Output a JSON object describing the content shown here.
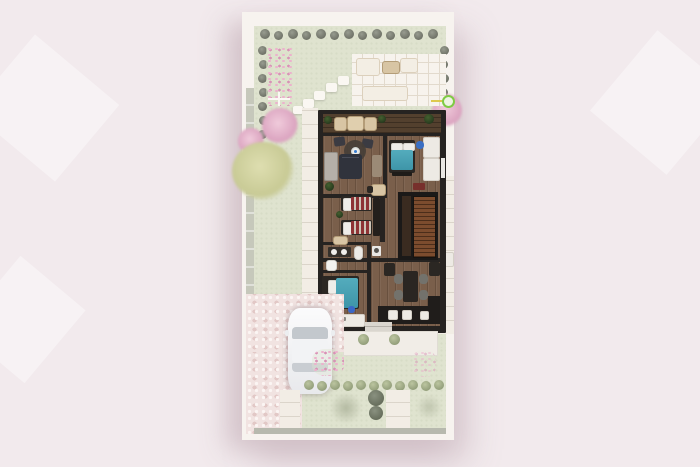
{
  "scene": {
    "kind": "architectural-site-plan-3d-render",
    "description": "Top-down render of a house ground floor with backyard patio, garden, front driveway and parked car",
    "visible_text": "none",
    "palette": {
      "page_background": "#f2eaed",
      "plan_paper": "#f7f3ef",
      "lawn": "#dfe3cf",
      "gray_path": "#c6c8bb",
      "patio_tile": "#f7f3ed",
      "house_wall": "#262321",
      "wood_floor": "#7a5f4b",
      "terrace_deck": "#53402e",
      "stair_wood": "#7c4c2e",
      "bed_blanket_teal": "#47a2b5",
      "kids_blanket_red": "#8e3335",
      "pink_blossom": "#dba4c0",
      "yellow_tree": "#c8ca95",
      "driveway_paver": "#f1e3e1",
      "car_body": "#f5f5f7",
      "hose_marker_green": "#7fcb45"
    }
  },
  "garden": {
    "backyard": [
      "hedge-row-top",
      "hedge-row-left",
      "hedge-row-right",
      "pink-flower-bed",
      "pink-tree",
      "yellow-tree",
      "paved-patio",
      "outdoor-lounge-set",
      "stepping-stones",
      "hose-marker"
    ],
    "frontyard": [
      "driveway",
      "parked-car",
      "front-lawn",
      "pink-flower-patches",
      "bush-row",
      "street-strip",
      "gray-tree"
    ]
  },
  "house": {
    "rooms": [
      {
        "name": "terrace",
        "furniture": [
          "potted-plants",
          "wicker-chairs",
          "outdoor-table"
        ]
      },
      {
        "name": "living-room",
        "furniture": [
          "sofa",
          "armchairs",
          "round-rug",
          "coffee-table",
          "cabinet",
          "tv-console",
          "plant",
          "side-table"
        ]
      },
      {
        "name": "bedroom-master",
        "furniture": [
          "double-bed-teal",
          "pillows",
          "desk",
          "blue-chair",
          "wardrobe",
          "red-bench"
        ]
      },
      {
        "name": "kids-bedroom",
        "furniture": [
          "single-bed-red-1",
          "single-bed-red-2",
          "wardrobe",
          "desk",
          "plant"
        ]
      },
      {
        "name": "bathroom",
        "furniture": [
          "double-vanity",
          "toilet",
          "boiler",
          "washer"
        ]
      },
      {
        "name": "bedroom-front",
        "furniture": [
          "double-bed-teal",
          "pillows",
          "dresser",
          "blue-pouf",
          "plant"
        ]
      },
      {
        "name": "staircase",
        "furniture": [
          "wood-treads"
        ]
      },
      {
        "name": "dining-area",
        "furniture": [
          "table",
          "chairs-x4",
          "sideboard",
          "cabinet"
        ]
      },
      {
        "name": "kitchen",
        "furniture": [
          "counter",
          "appliances"
        ]
      },
      {
        "name": "entrance-porch",
        "furniture": [
          "steps",
          "round-bushes-x2"
        ]
      }
    ]
  }
}
